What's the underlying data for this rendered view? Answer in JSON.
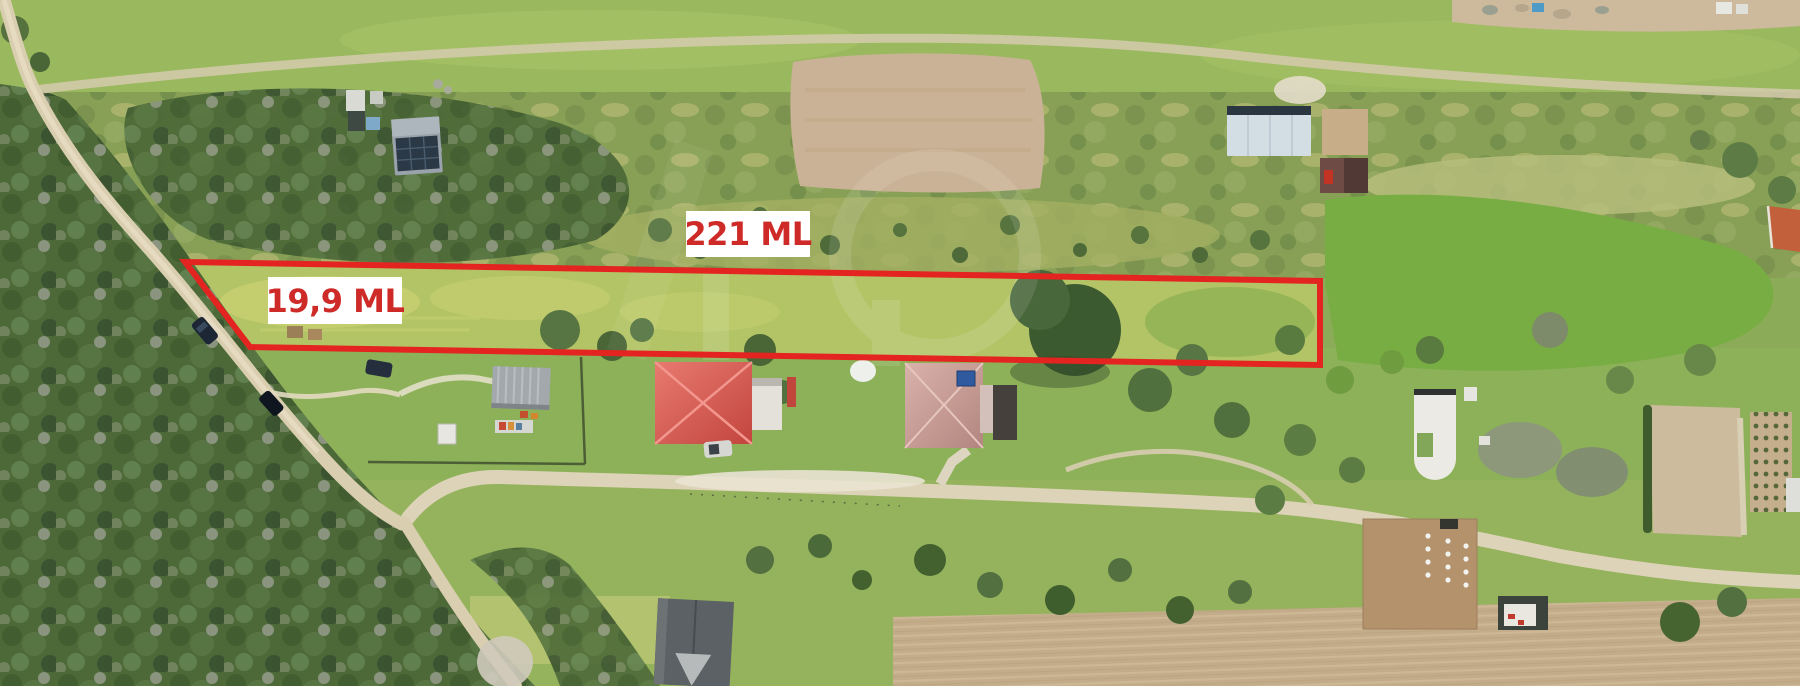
{
  "photo": {
    "kind": "aerial drone photo of rural land plot for sale",
    "annotation": {
      "boundary_points": "185,262 1320,281 1320,365 250,347",
      "boundary_color": "#e32420",
      "label_bg_color": "#ffffff",
      "label_text_color": "#ce2b28",
      "labels": [
        {
          "id": "plot-length",
          "text": "221 ML"
        },
        {
          "id": "plot-width",
          "text": "19,9 ML"
        }
      ]
    }
  }
}
